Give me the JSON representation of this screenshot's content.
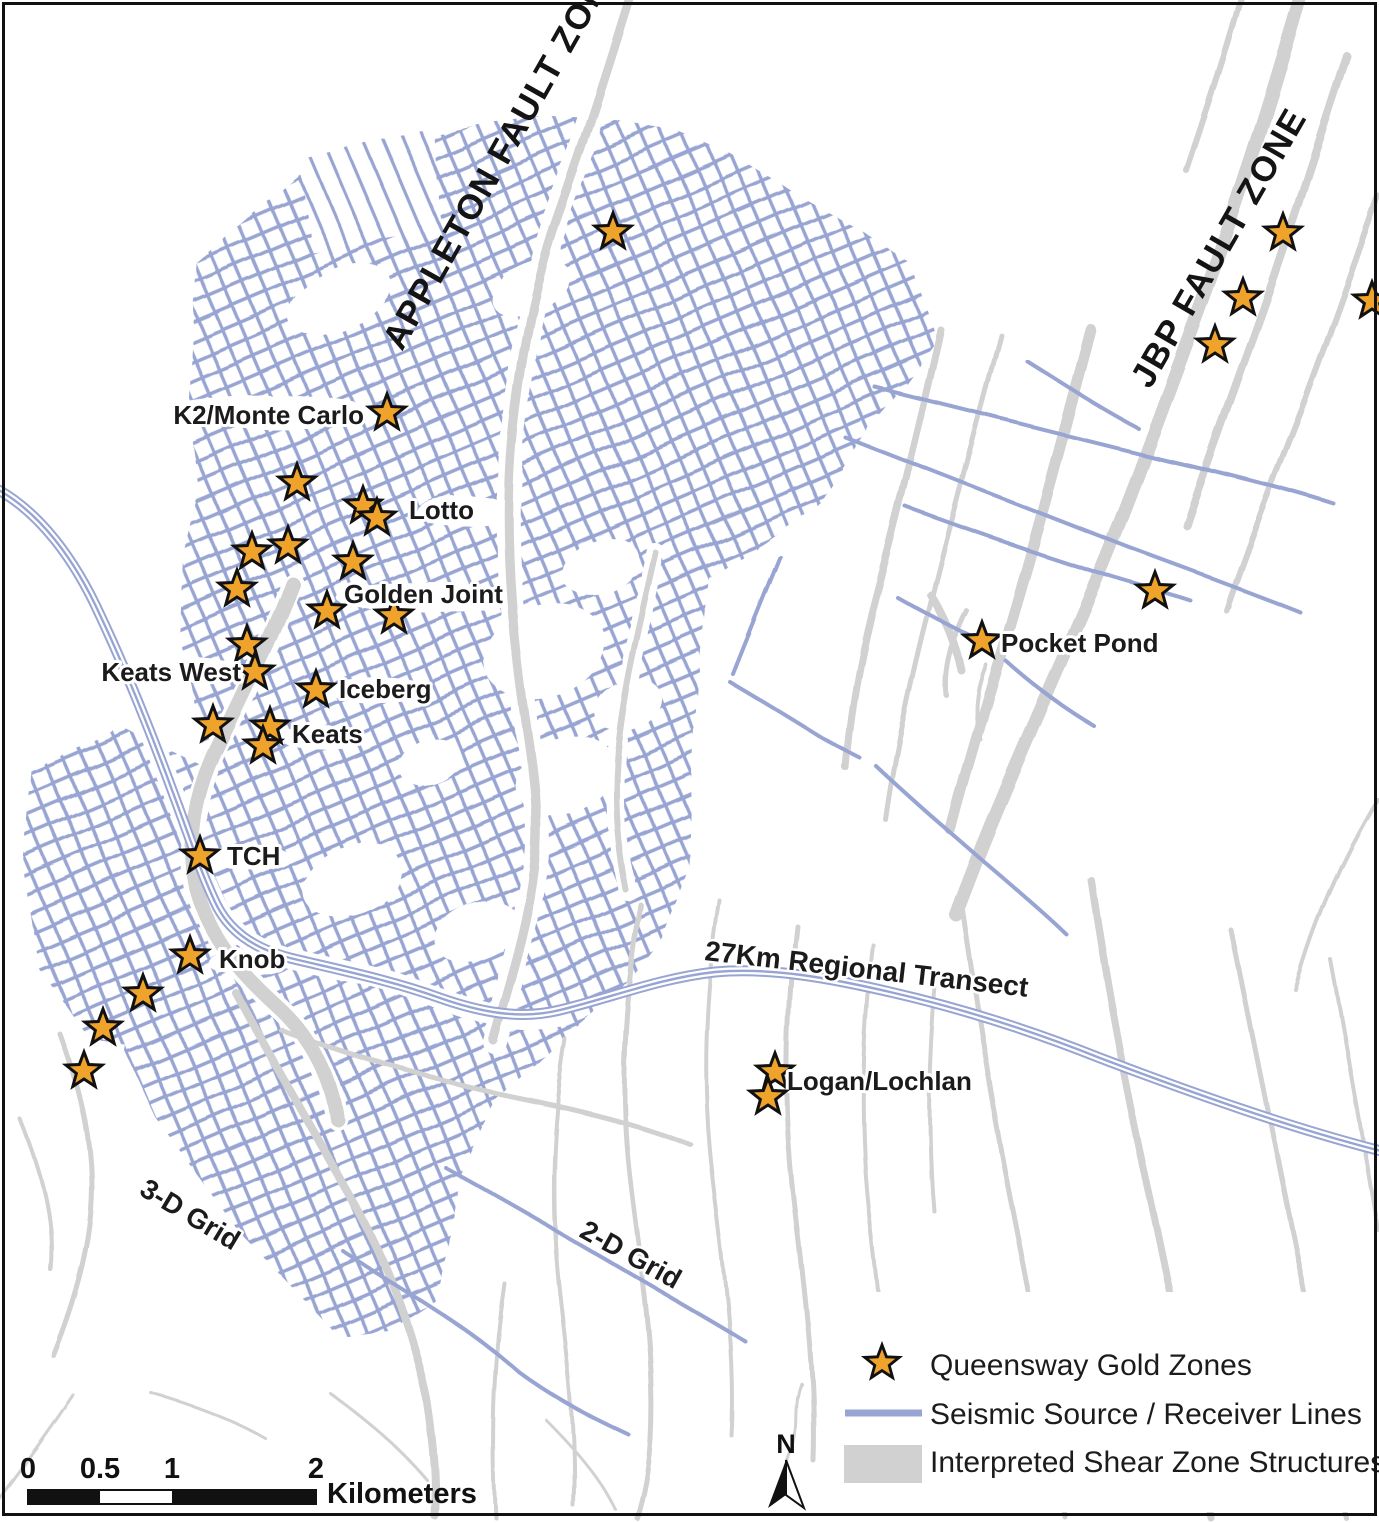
{
  "map": {
    "fault_zone_labels": [
      {
        "text": "APPLETON FAULT ZONE",
        "x": 402,
        "y": 352,
        "rotation": -60.5
      },
      {
        "text": "JBP FAULT ZONE",
        "x": 1150,
        "y": 390,
        "rotation": -60
      }
    ],
    "area_labels": [
      {
        "text": "27Km Regional Transect",
        "x": 704,
        "y": 960,
        "rotation": 6.5
      },
      {
        "text": "3-D Grid",
        "x": 138,
        "y": 1194,
        "rotation": 31
      },
      {
        "text": "2-D Grid",
        "x": 578,
        "y": 1236,
        "rotation": 29
      }
    ],
    "gold_zones": [
      {
        "x": 613,
        "y": 232
      },
      {
        "x": 1283,
        "y": 233
      },
      {
        "x": 1243,
        "y": 298
      },
      {
        "x": 1215,
        "y": 345
      },
      {
        "x": 1372,
        "y": 301
      },
      {
        "x": 387,
        "y": 413,
        "label": "K2/Monte Carlo",
        "lx": 364,
        "ly": 424,
        "anchor": "end"
      },
      {
        "x": 297,
        "y": 483
      },
      {
        "x": 363,
        "y": 506,
        "label": "Lotto",
        "lx": 409,
        "ly": 519,
        "anchor": "start"
      },
      {
        "x": 377,
        "y": 518
      },
      {
        "x": 288,
        "y": 546
      },
      {
        "x": 252,
        "y": 552
      },
      {
        "x": 353,
        "y": 562
      },
      {
        "x": 237,
        "y": 589
      },
      {
        "x": 327,
        "y": 611
      },
      {
        "x": 394,
        "y": 616,
        "label": "Golden Joint",
        "lx": 344,
        "ly": 603,
        "anchor": "start"
      },
      {
        "x": 247,
        "y": 645
      },
      {
        "x": 255,
        "y": 672,
        "label": "Keats West",
        "lx": 241,
        "ly": 681,
        "anchor": "end"
      },
      {
        "x": 316,
        "y": 690,
        "label": "Iceberg",
        "lx": 339,
        "ly": 698,
        "anchor": "start"
      },
      {
        "x": 213,
        "y": 725
      },
      {
        "x": 270,
        "y": 727,
        "label": "Keats",
        "lx": 292,
        "ly": 743,
        "anchor": "start"
      },
      {
        "x": 263,
        "y": 746
      },
      {
        "x": 200,
        "y": 856,
        "label": "TCH",
        "lx": 227,
        "ly": 865,
        "anchor": "start"
      },
      {
        "x": 190,
        "y": 956,
        "label": "Knob",
        "lx": 219,
        "ly": 968,
        "anchor": "start"
      },
      {
        "x": 143,
        "y": 994
      },
      {
        "x": 103,
        "y": 1028
      },
      {
        "x": 84,
        "y": 1071
      },
      {
        "x": 982,
        "y": 641,
        "label": "Pocket Pond",
        "lx": 1001,
        "ly": 652,
        "anchor": "start"
      },
      {
        "x": 1155,
        "y": 591
      },
      {
        "x": 775,
        "y": 1072,
        "label": "Logan/Lochlan",
        "lx": 787,
        "ly": 1090,
        "anchor": "start"
      },
      {
        "x": 768,
        "y": 1097
      }
    ]
  },
  "legend": {
    "items": [
      {
        "type": "star",
        "label": "Queensway Gold Zones"
      },
      {
        "type": "line",
        "label": "Seismic Source / Receiver Lines"
      },
      {
        "type": "area",
        "label": "Interpreted Shear Zone Structures"
      }
    ]
  },
  "scale_bar": {
    "ticks": [
      "0",
      "0.5",
      "1",
      "2"
    ],
    "unit": "Kilometers"
  },
  "north_arrow": {
    "label": "N"
  },
  "colors": {
    "seismic_line": "#98A5D3",
    "shear_zone": "#D1D1D1",
    "gold_star_fill": "#EFA32B",
    "gold_star_stroke": "#111111",
    "map_label": "#1b1b1b"
  }
}
